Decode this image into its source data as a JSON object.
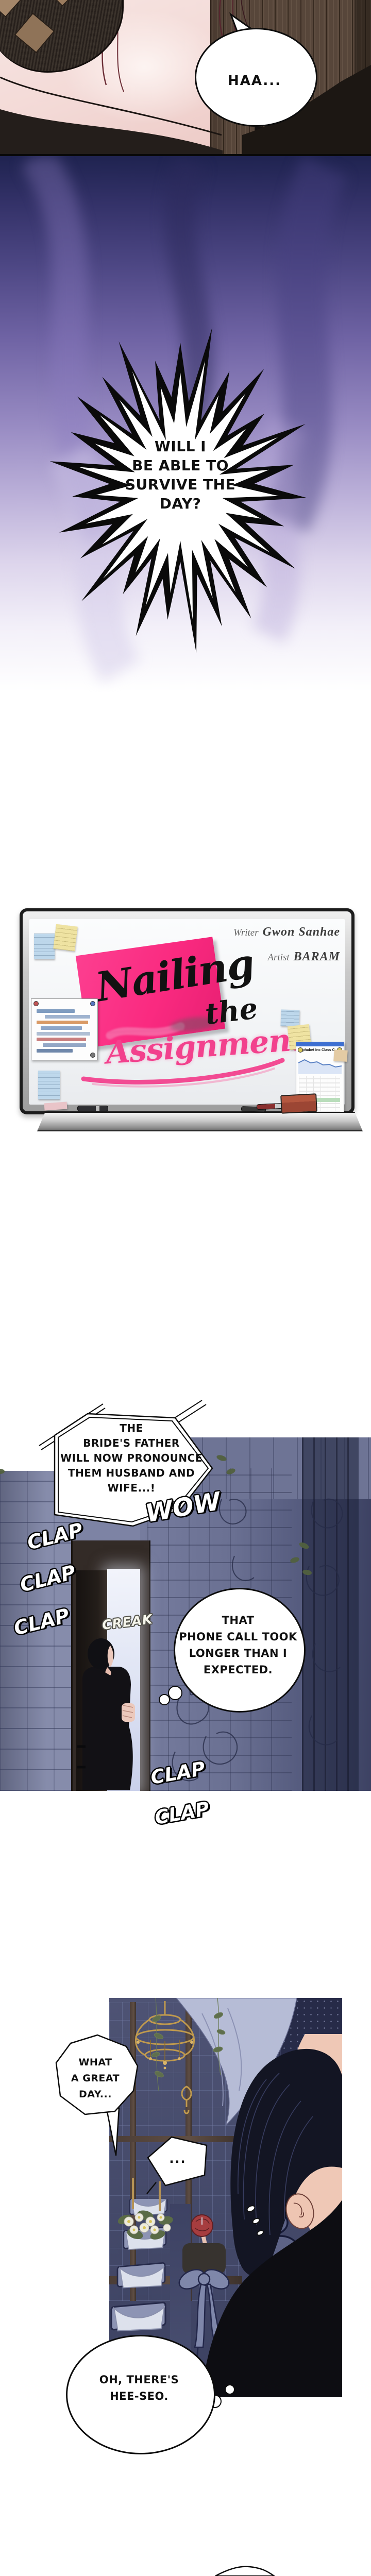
{
  "panel1": {
    "sigh": "HAA..."
  },
  "panel2": {
    "burst_lines": [
      "WILL I",
      "BE ABLE TO",
      "SURVIVE THE",
      "DAY?"
    ]
  },
  "title_board": {
    "writer_label": "Writer",
    "writer_name": "Gwon Sanhae",
    "artist_label": "Artist",
    "artist_name": "BARAM",
    "title_line1": "Nailing",
    "title_line2": "the",
    "title_line3": "Assignment",
    "paper_title": "Alphabet Inc Class C"
  },
  "panel3": {
    "caption_lines": [
      "THE",
      "BRIDE'S FATHER",
      "WILL NOW PRONOUNCE",
      "THEM HUSBAND AND",
      "WIFE...!"
    ],
    "sfx_wow": "WOW",
    "sfx_clap": "CLAP",
    "sfx_creak": "CREAK",
    "thought_lines": [
      "THAT",
      "PHONE CALL TOOK",
      "LONGER THAN I",
      "EXPECTED."
    ]
  },
  "panel4": {
    "bubble_lines": [
      "WHAT",
      "A GREAT",
      "DAY..."
    ],
    "ellipsis": "...",
    "thought_lines": [
      "OH, THERE'S",
      "HEE-SEO."
    ]
  },
  "colors": {
    "accent_pink": "#fb2e84",
    "purple_mid": "#6f63a4",
    "wall_blue": "#7d83a4"
  }
}
